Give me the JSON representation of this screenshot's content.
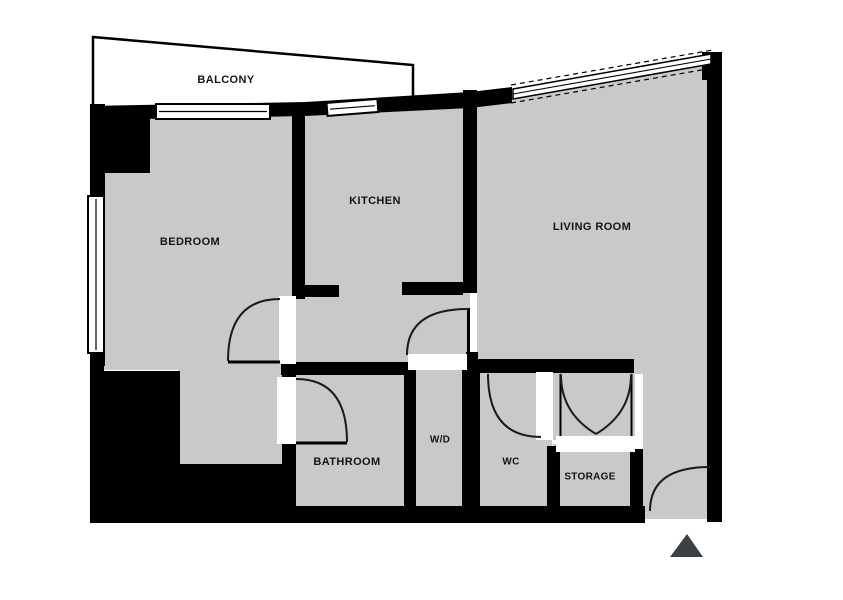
{
  "plan": {
    "title": "Apartment floor plan",
    "rooms": {
      "balcony": {
        "label": "BALCONY"
      },
      "bedroom": {
        "label": "BEDROOM"
      },
      "kitchen": {
        "label": "KITCHEN"
      },
      "living_room": {
        "label": "LIVING ROOM"
      },
      "bathroom": {
        "label": "BATHROOM"
      },
      "wd": {
        "label": "W/D"
      },
      "wc": {
        "label": "WC"
      },
      "storage": {
        "label": "STORAGE"
      }
    }
  },
  "colors": {
    "background": "#ffffff",
    "floor": "#c9c9c9",
    "wall": "#000000",
    "door_gap": "#ffffff",
    "door_arc": "#1a1a1a",
    "window_fill": "#ffffff",
    "entrance_marker": "#3b4046"
  }
}
